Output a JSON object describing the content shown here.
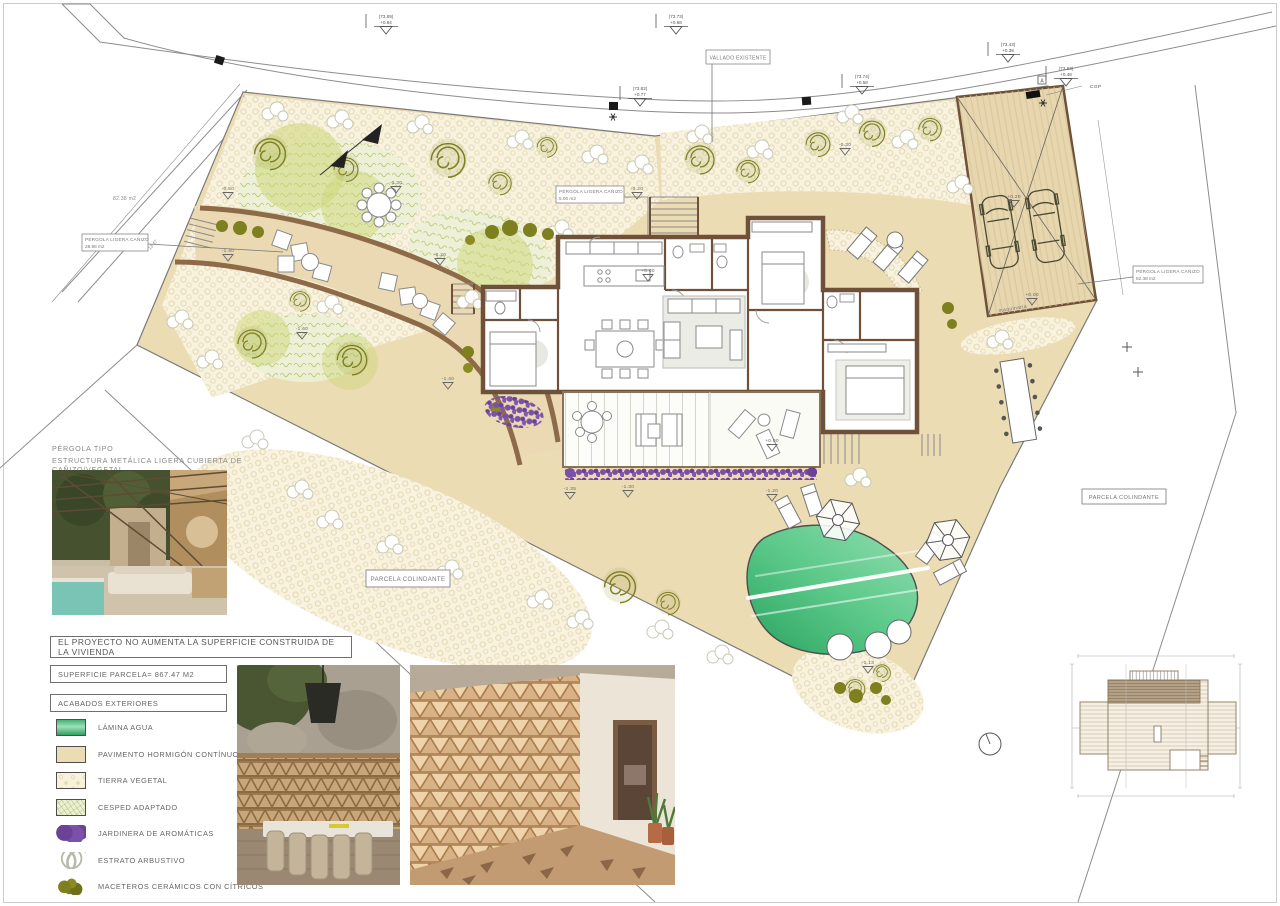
{
  "page": {
    "border_color": "#cccccc"
  },
  "plan": {
    "labels": {
      "vallado": "VALLADO EXISTENTE",
      "parcela": "PARCELA COLINDANTE",
      "pergola_line1": "PÉRGOLA LIGERA CAÑIZO",
      "area_center": "5.00 m2",
      "area_left_box": "28.98 m2",
      "area_right_box": "82.38 m2",
      "area_left_text": "82.38 m2",
      "dim_left": "13.47",
      "cgp": "CGP",
      "symbol_a": "A",
      "maquinaria": "maquinaria"
    },
    "survey_markers": [
      {
        "x": 386,
        "y": 18,
        "elev": "(73.89)",
        "delta": "+0.84"
      },
      {
        "x": 676,
        "y": 18,
        "elev": "(73.73)",
        "delta": "+0.68"
      },
      {
        "x": 1008,
        "y": 46,
        "elev": "(73.43)",
        "delta": "+0.38"
      },
      {
        "x": 640,
        "y": 90,
        "elev": "(73.82)",
        "delta": "+0.77"
      },
      {
        "x": 862,
        "y": 78,
        "elev": "(73.74)",
        "delta": "+0.58"
      },
      {
        "x": 1066,
        "y": 70,
        "elev": "(73.53)",
        "delta": "+0.48"
      }
    ],
    "spot_levels": [
      {
        "x": 845,
        "y": 146,
        "text": "-0.30"
      },
      {
        "x": 228,
        "y": 190,
        "text": "-0.50"
      },
      {
        "x": 396,
        "y": 184,
        "text": "-0.30"
      },
      {
        "x": 637,
        "y": 190,
        "text": "-0.20"
      },
      {
        "x": 228,
        "y": 252,
        "text": "-1.40"
      },
      {
        "x": 440,
        "y": 256,
        "text": "-0.20"
      },
      {
        "x": 302,
        "y": 330,
        "text": "-1.60"
      },
      {
        "x": 448,
        "y": 380,
        "text": "-1.40"
      },
      {
        "x": 648,
        "y": 272,
        "text": "+0.00"
      },
      {
        "x": 570,
        "y": 490,
        "text": "-1.35"
      },
      {
        "x": 628,
        "y": 488,
        "text": "-1.30"
      },
      {
        "x": 772,
        "y": 492,
        "text": "-1.20"
      },
      {
        "x": 772,
        "y": 442,
        "text": "+0.00"
      },
      {
        "x": 868,
        "y": 664,
        "text": "-1.13"
      },
      {
        "x": 1014,
        "y": 198,
        "text": "+0.20"
      },
      {
        "x": 1032,
        "y": 296,
        "text": "+0.00"
      }
    ]
  },
  "panel": {
    "pergola_tipo_title": "PÉRGOLA TIPO",
    "pergola_tipo_subtitle": "ESTRUCTURA METÁLICA LIGERA CUBIERTA DE CAÑIZO/VEGETAL",
    "note": "EL PROYECTO NO AUMENTA LA SUPERFICIE CONSTRUIDA DE LA VIVIENDA",
    "superficie": "SUPERFICIE PARCELA= 867.47 M2",
    "acabados_title": "ACABADOS  EXTERIORES"
  },
  "legend": {
    "items": [
      {
        "key": "lamina",
        "label": "LÁMINA AGUA"
      },
      {
        "key": "pavimento",
        "label": "PAVIMENTO HORMIGÓN CONTÍNUO"
      },
      {
        "key": "tierra",
        "label": "TIERRA VEGETAL"
      },
      {
        "key": "cesped",
        "label": "CESPED ADAPTADO"
      },
      {
        "key": "jardinera",
        "label": "JARDINERA  DE AROMÁTICAS"
      },
      {
        "key": "estrato",
        "label": "ESTRATO ARBUSTIVO"
      },
      {
        "key": "maceteros",
        "label": "MACETEROS CERÁMICOS CON CÍTRICOS"
      }
    ]
  },
  "colors": {
    "pavement_beige": "#ecdcb4",
    "tierra_cream": "#f8f2de",
    "pool_green": "#35b96b",
    "aromatics_purple": "#7b51a7",
    "olive_green": "#7f7f23",
    "wall_brown": "#6e5138",
    "path_edge_brown": "#8d6b49",
    "line_gray": "#8a8a8a"
  }
}
